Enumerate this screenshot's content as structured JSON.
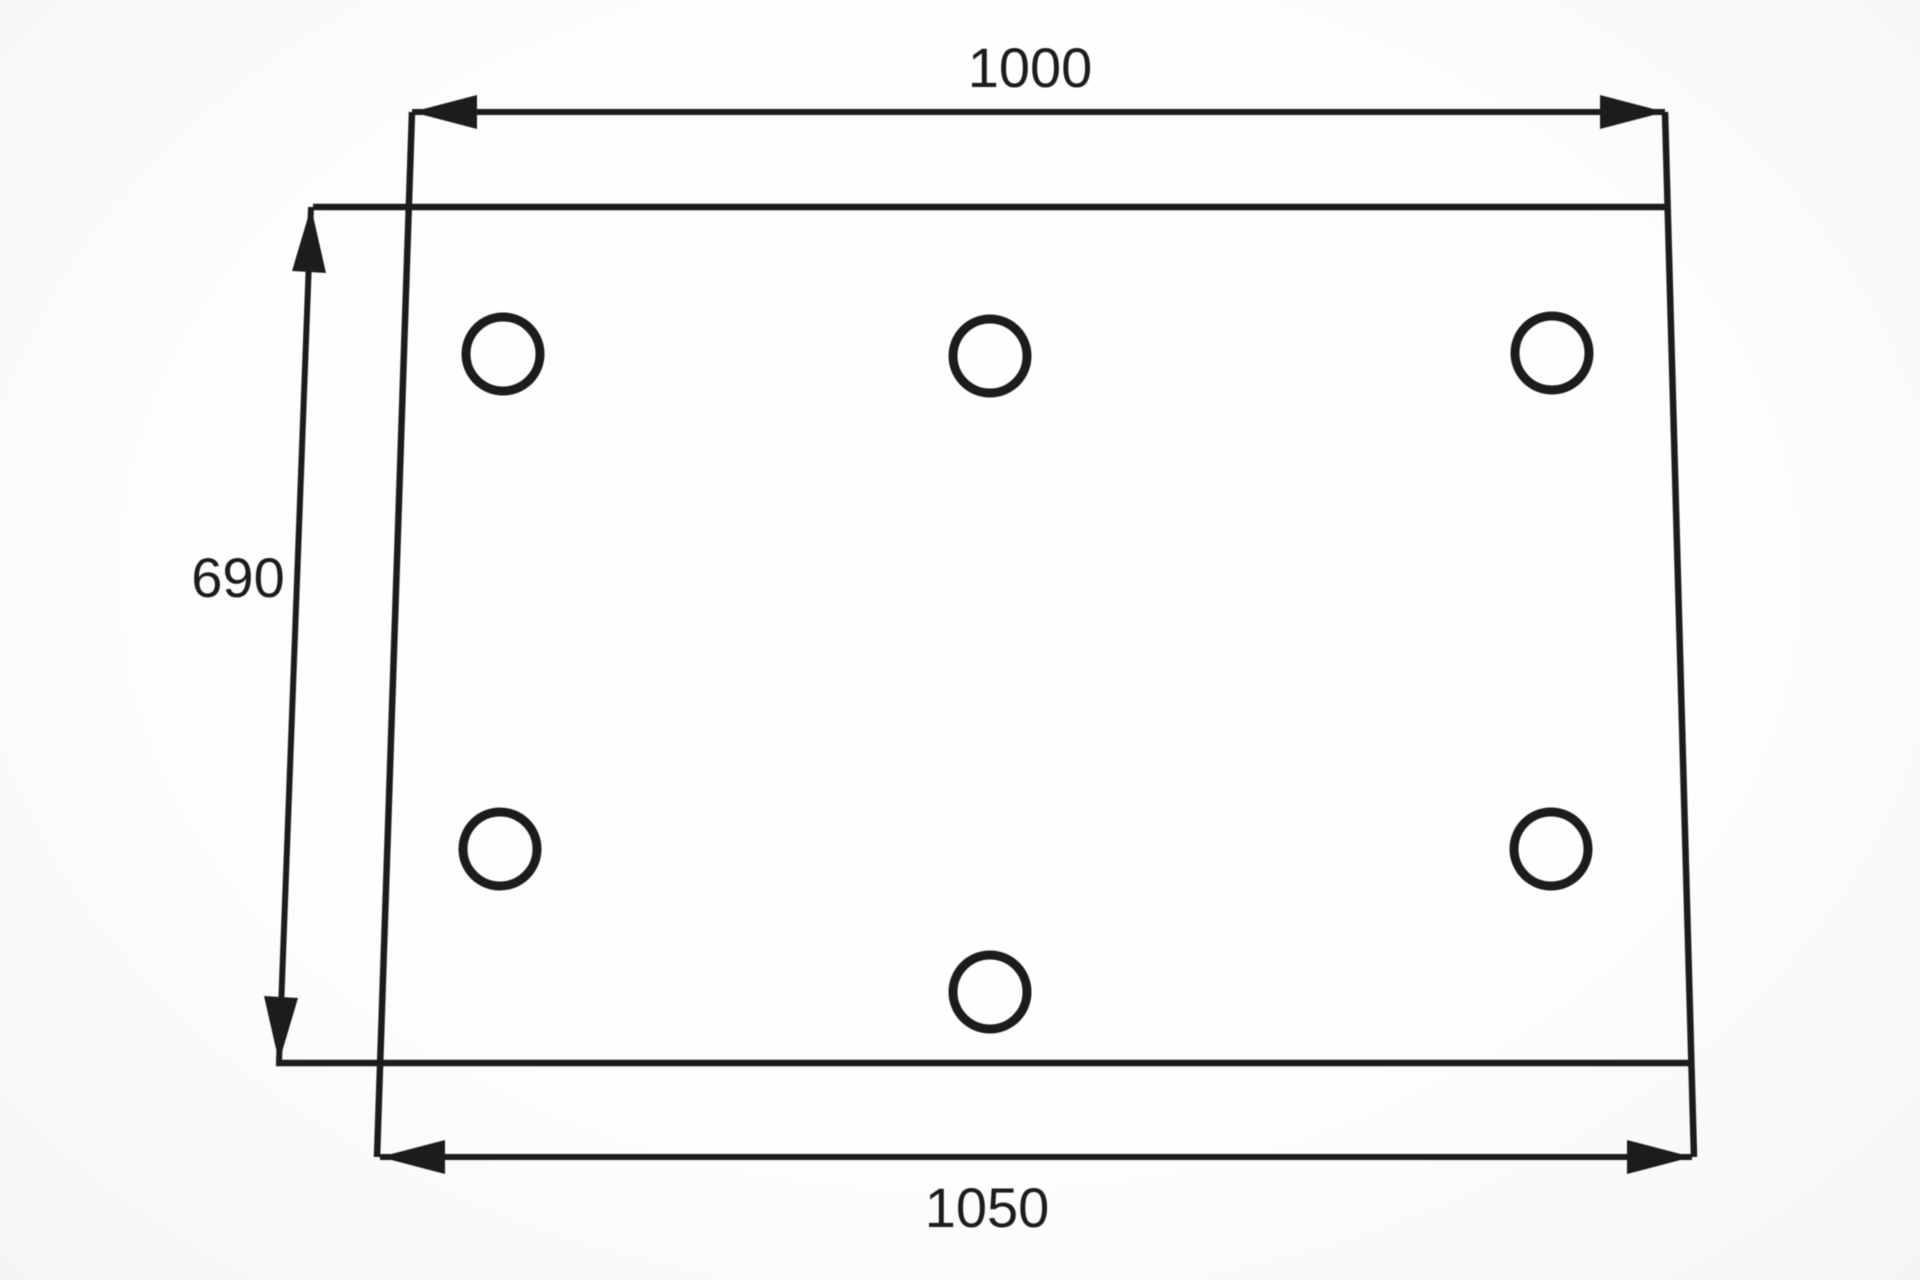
{
  "colors": {
    "ink": "#1c1c1c",
    "paper": "#fcfcfc"
  },
  "dimensions": {
    "top": {
      "label": "1000"
    },
    "left": {
      "label": "690"
    },
    "bottom": {
      "label": "1050"
    }
  },
  "holes": {
    "count": 6,
    "radius": 37,
    "stroke_width": 9,
    "centers": [
      {
        "x": 503,
        "y": 354
      },
      {
        "x": 990,
        "y": 356
      },
      {
        "x": 1552,
        "y": 353
      },
      {
        "x": 500,
        "y": 849
      },
      {
        "x": 1551,
        "y": 849
      },
      {
        "x": 990,
        "y": 992
      }
    ]
  }
}
